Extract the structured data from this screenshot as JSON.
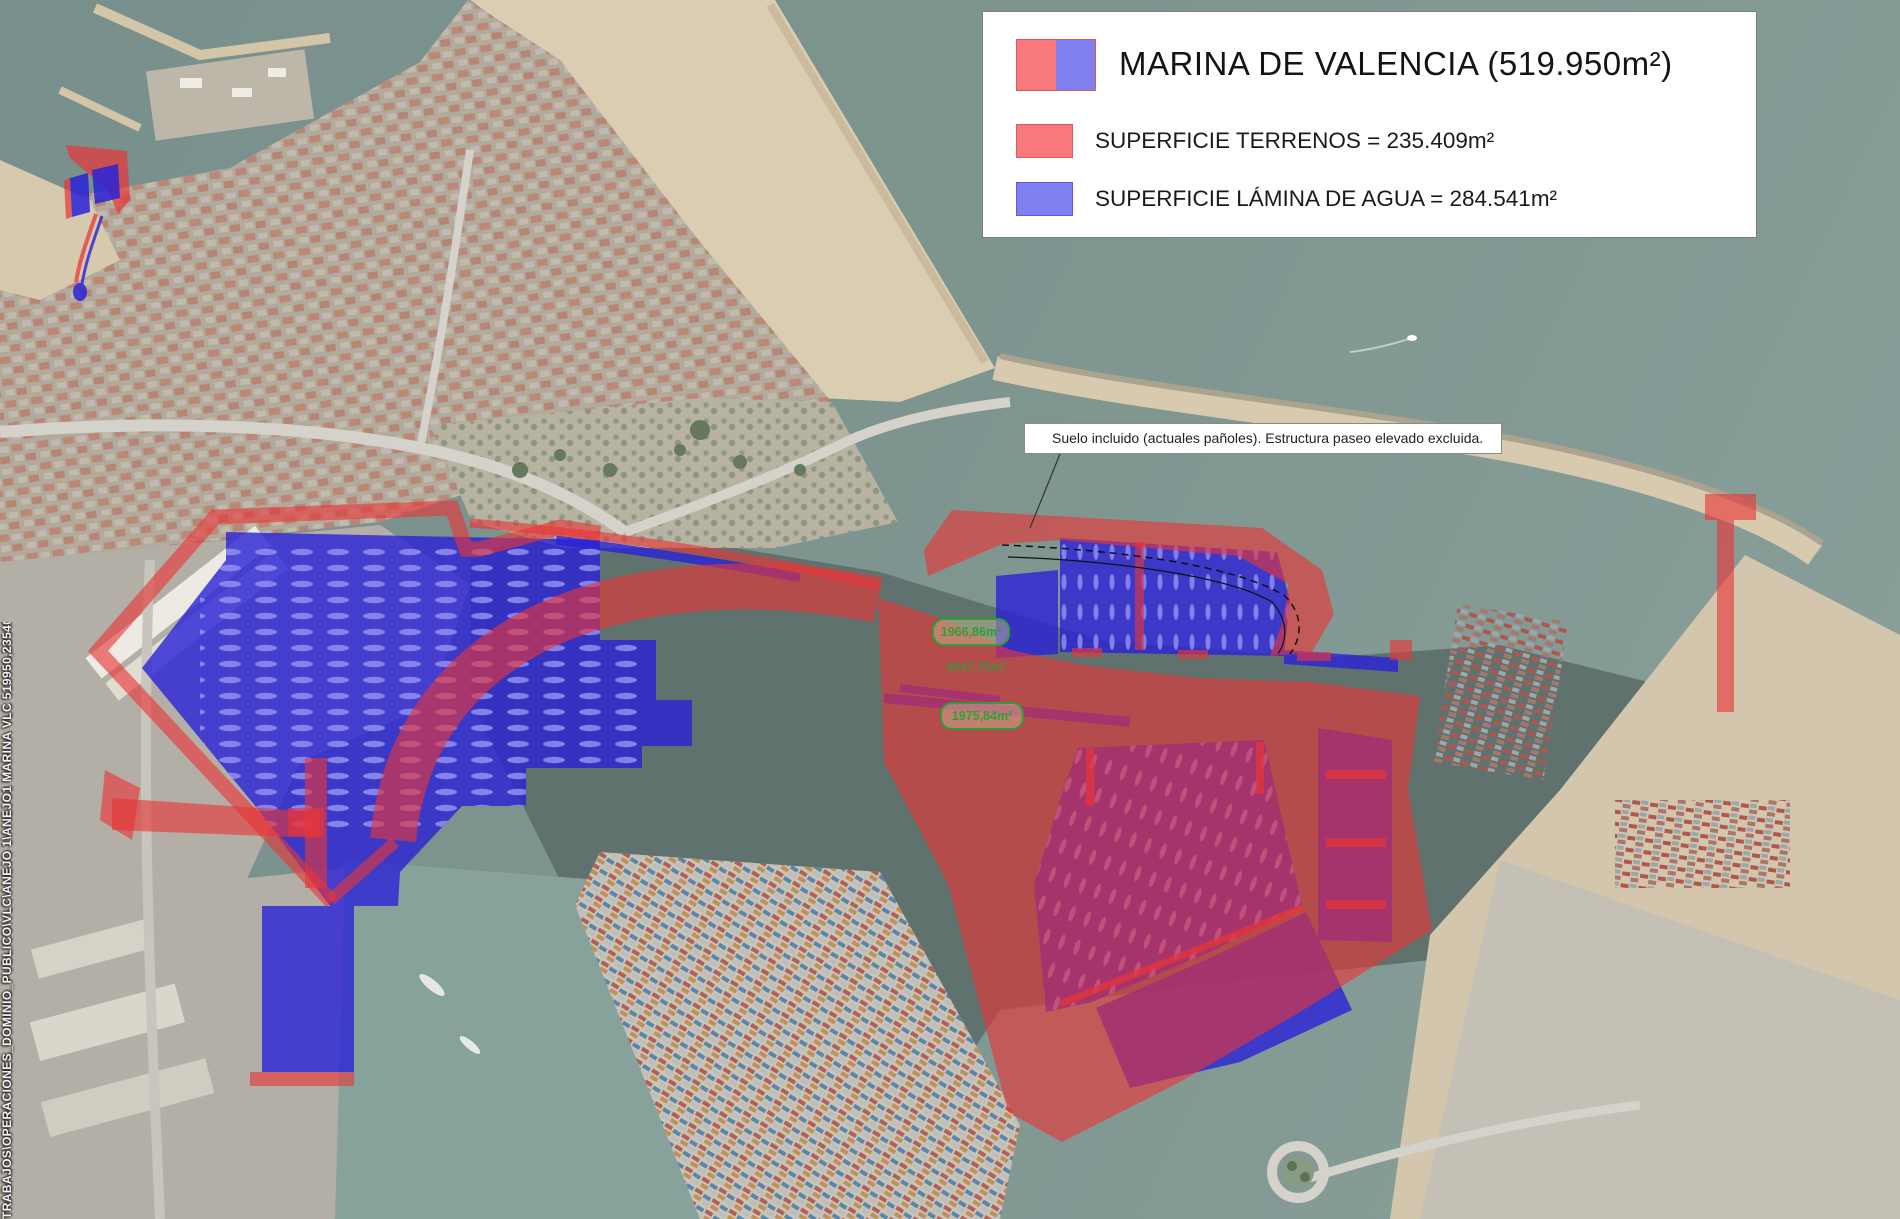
{
  "legend": {
    "title": "MARINA DE VALENCIA (519.950m²)",
    "items": [
      {
        "label": "SUPERFICIE TERRENOS = 235.409m²",
        "color": "#f8797c"
      },
      {
        "label": "SUPERFICIE LÁMINA DE AGUA = 284.541m²",
        "color": "#7f7ff0"
      }
    ],
    "title_swatch_colors": [
      "#f8797c",
      "#7f7ff0"
    ]
  },
  "note": {
    "text": "Suelo incluido (actuales pañoles). Estructura paseo elevado excluida."
  },
  "area_labels": [
    {
      "value": "1966,86m²"
    },
    {
      "value": "3947,70m²"
    },
    {
      "value": "1975,84m²"
    }
  ],
  "file_path": "TRABAJOS\\OPERACIONES_DOMINIO_PUBLICO\\VLC\\ANEJO 1\\ANEJO1 MARINA VLC 519950,235409 284541m².dwg",
  "colors": {
    "terrain_overlay_red": "#e93537",
    "water_overlay_blue": "#2a22d6",
    "area_label_green": "#2f9e38",
    "sea": "#7e948f",
    "sand": "#dbcdb2",
    "harbor_dark_water": "#60726e"
  }
}
